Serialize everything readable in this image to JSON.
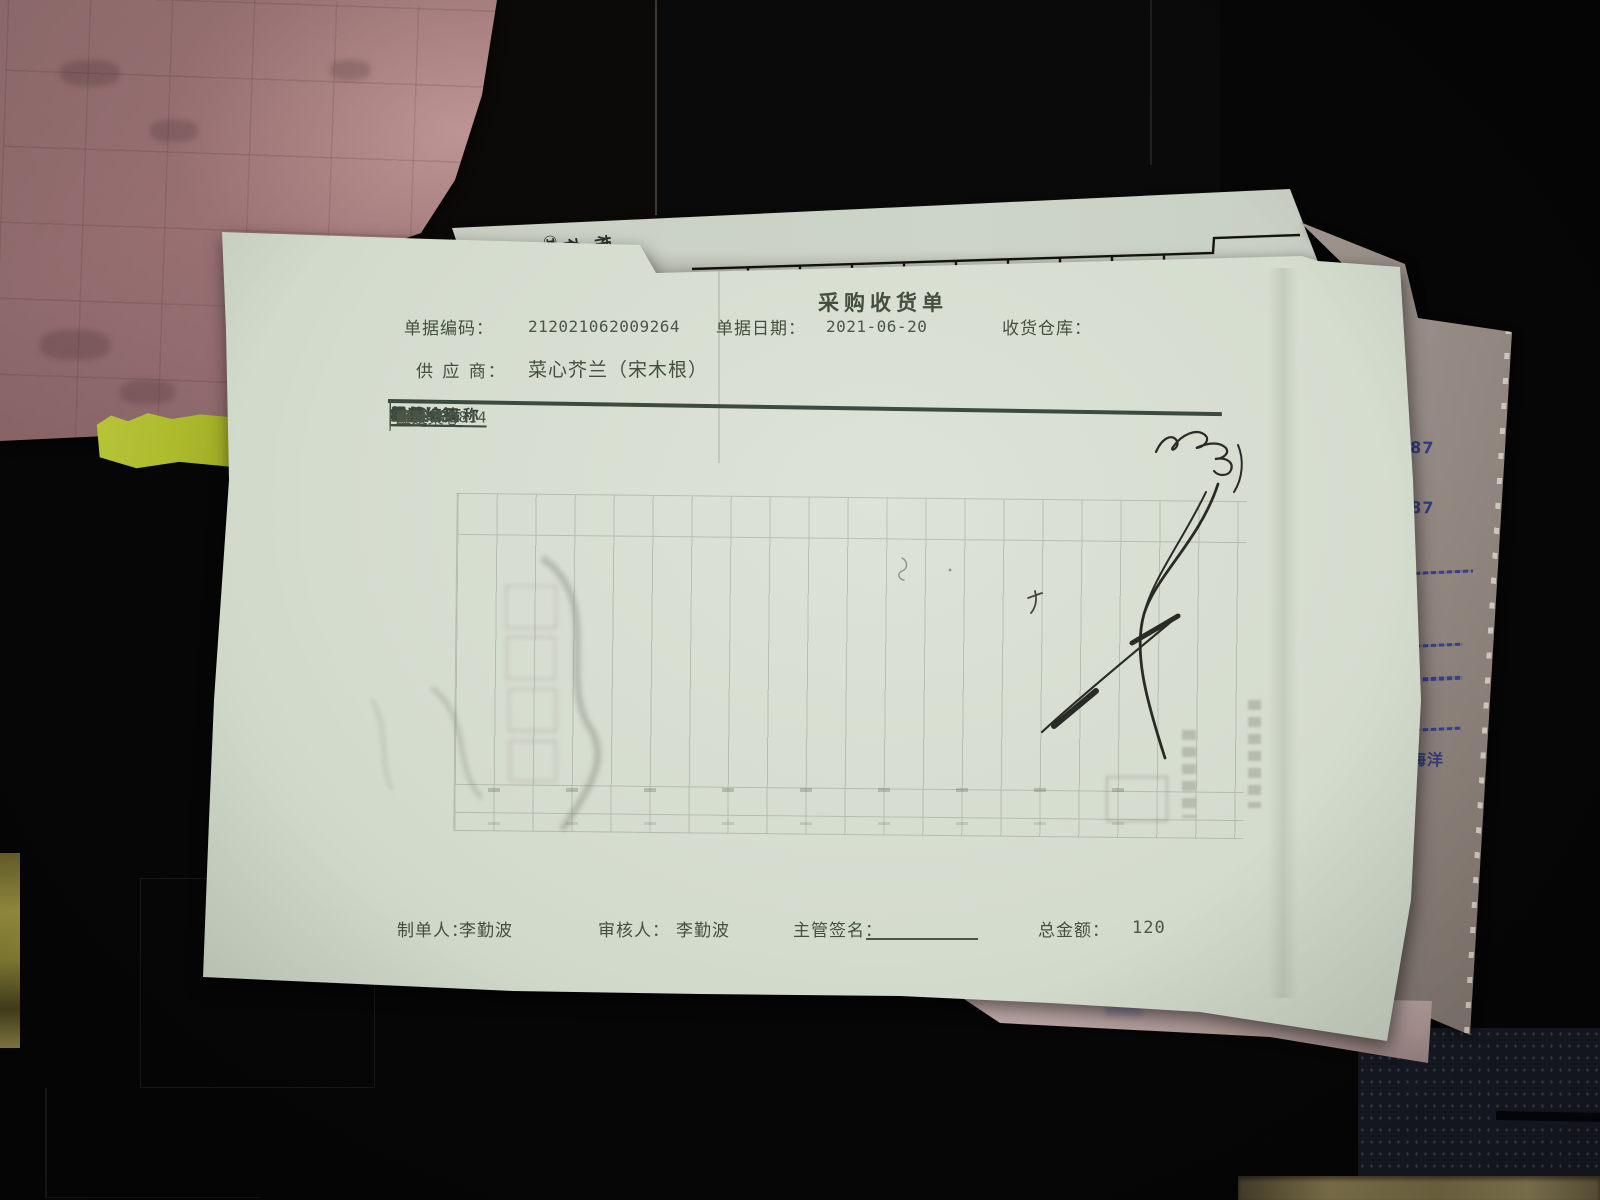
{
  "receipt": {
    "title": "采购收货单",
    "fields": {
      "doc_code_label": "单据编码：",
      "doc_code": "212021062009264",
      "doc_date_label": "单据日期：",
      "doc_date": "2021-06-20",
      "warehouse_label": "收货仓库：",
      "supplier_label": "供 应 商：",
      "supplier": "菜心芥兰（宋木根）"
    },
    "table": {
      "headers": [
        "材料编码",
        "材料名称",
        "规格",
        "单位",
        "数量",
        "单价",
        "金额",
        "收货仓库"
      ],
      "rows": [
        [
          "0010100814",
          "空运菜心",
          "斤",
          "斤",
          "20",
          "6",
          "120",
          "粤菜"
        ]
      ]
    },
    "footer": {
      "maker_label": "制单人：",
      "maker": "李勤波",
      "auditor_label": "审核人：",
      "auditor": "李勤波",
      "supervisor_label": "主管签名：",
      "total_label": "总金额：",
      "total": "120"
    }
  },
  "stub_paper": {
    "mark": "①",
    "char1": "存",
    "char2": "根"
  },
  "side_paper": {
    "line1": "187",
    "line2": "287",
    "line3": "注",
    "line4": "王海洋"
  },
  "colors": {
    "receipt_paper": "#d5dccf",
    "print_ink": "#44503f",
    "signature_ink": "#1a1c18",
    "side_paper_ink": "#343e85",
    "pink_paper": "#a87e7f",
    "yellow_sticker": "#b5c232",
    "background": "#070606"
  }
}
